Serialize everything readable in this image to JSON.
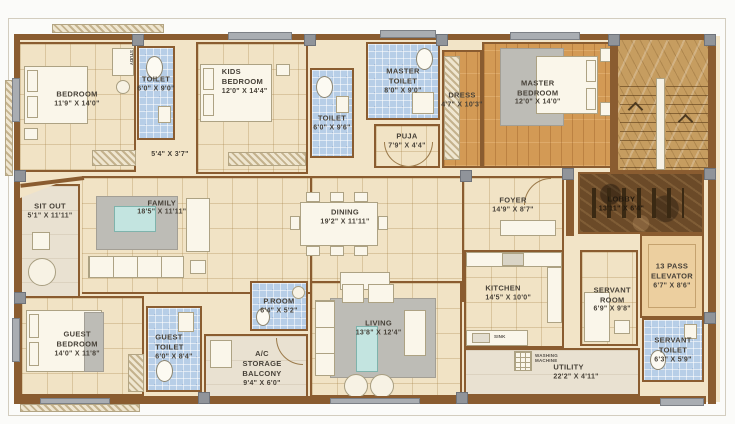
{
  "plan_title": "Apartment floor plan",
  "colors": {
    "wall": "#8a5c30",
    "floor_tile": "#f1e3c5",
    "floor_blue_tile": "#b7cee7",
    "floor_wood": "#d39a55",
    "floor_marble_dark": "#6b4a28",
    "floor_marble_gold": "#c69d60",
    "floor_elevator": "#eccf9f",
    "floor_balcony": "#e9e1d1",
    "accent_gray": "#a9adb2",
    "rug_gray": "#bdbcb6",
    "table_teal": "#c3e4e0",
    "label_text": "#474138"
  },
  "rooms": [
    {
      "name": "BEDROOM",
      "dims": "11'9\" X 14'0\""
    },
    {
      "name": "TOILET",
      "dims": "6'0\" X 9'0\""
    },
    {
      "name": "KIDS\nBEDROOM",
      "dims": "12'0\" X 14'4\""
    },
    {
      "name": "TOILET",
      "dims": "6'0\" X 9'6\""
    },
    {
      "name": "MASTER\nTOILET",
      "dims": "8'0\" X 9'0\""
    },
    {
      "name": "PUJA",
      "dims": "7'9\" X 4'4\""
    },
    {
      "name": "DRESS",
      "dims": "4'7\" X 10'3\""
    },
    {
      "name": "MASTER\nBEDROOM",
      "dims": "12'0\" X 14'0\""
    },
    {
      "name": "",
      "dims": "5'4\" X 3'7\""
    },
    {
      "name": "SIT OUT",
      "dims": "5'1\" X 11'11\""
    },
    {
      "name": "FAMILY",
      "dims": "18'5\" X 11'11\""
    },
    {
      "name": "DINING",
      "dims": "19'2\" X 11'11\""
    },
    {
      "name": "FOYER",
      "dims": "14'9\" X 8'7\""
    },
    {
      "name": "LOBBY",
      "dims": "13'11\" X 6'4\""
    },
    {
      "name": "13 PASS\nELEVATOR",
      "dims": "6'7\" X 8'6\""
    },
    {
      "name": "GUEST\nBEDROOM",
      "dims": "14'0\" X 11'8\""
    },
    {
      "name": "GUEST\nTOILET",
      "dims": "6'0\" X 8'4\""
    },
    {
      "name": "P.ROOM",
      "dims": "6'4\" X 5'2\""
    },
    {
      "name": "A/C STORAGE\nBALCONY",
      "dims": "9'4\" X 6'0\""
    },
    {
      "name": "LIVING",
      "dims": "13'8\" X 12'4\""
    },
    {
      "name": "KITCHEN",
      "dims": "14'5\" X 10'0\""
    },
    {
      "name": "SERVANT\nROOM",
      "dims": "6'9\" X 9'8\""
    },
    {
      "name": "SERVANT\nTOILET",
      "dims": "6'3\" X 5'9\""
    },
    {
      "name": "UTILITY",
      "dims": "22'2\" X 4'11\""
    }
  ],
  "annotations": {
    "study": "STUDY",
    "sink": "SINK",
    "washing_machine": "WASHING\nMACHINE"
  }
}
